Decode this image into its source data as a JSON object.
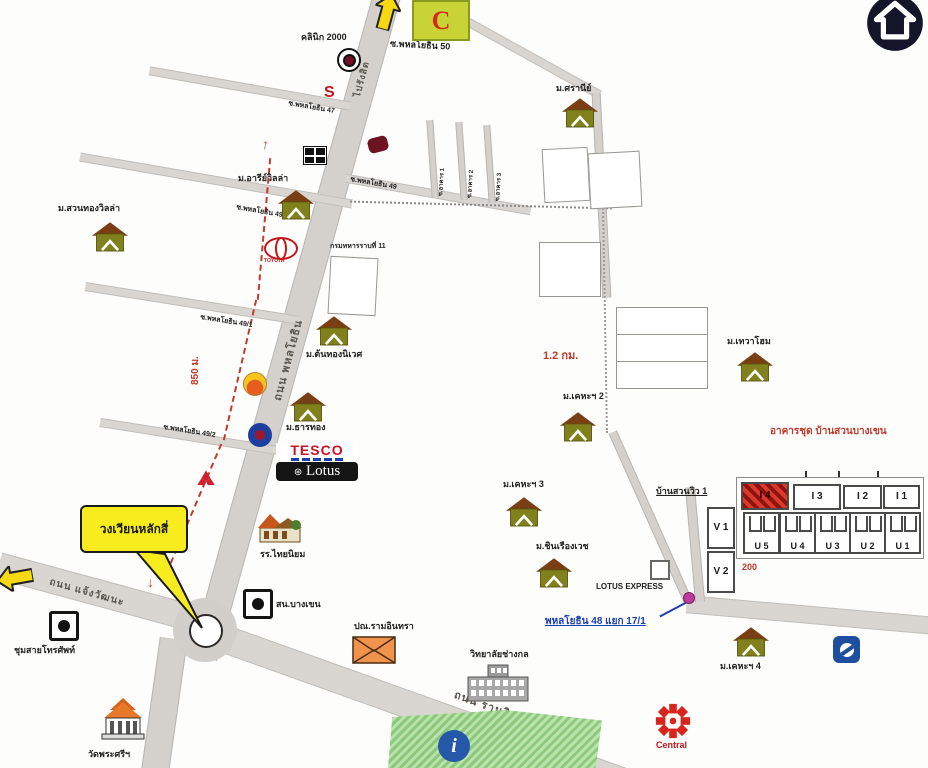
{
  "ui": {
    "home_button": "back-to-top"
  },
  "roads": {
    "phahonyothin": "ถนน พหลโยธิน",
    "to_rangsit": "ไปรังสิต",
    "chaengwattana": "ถนน แจ้งวัฒนะ",
    "ramindra": "ถนน รามอินทรา",
    "soi_50": "ซ.พหลโยธิน 50",
    "soi_47": "ซ.พหลโยธิน 47",
    "soi_49_left": "ซ.พหลโยธิน 49",
    "soi_49_right": "ซ.พหลโยธิน 49",
    "soi_49_1": "ซ.พหลโยธิน 49/1",
    "soi_49_2": "ซ.พหลโยธิน 49/2",
    "soi_akan_1": "ซ.อาคาร 1",
    "soi_akan_2": "ซ.อาคาร 2",
    "soi_akan_3": "ซ.อาคาร 3",
    "phahonyothin_48": "พหลโยธิน 48 แยก 17/1"
  },
  "distances": {
    "d850": "850 ม.",
    "d1200": "1.2 กม.",
    "d200": "200"
  },
  "callout": {
    "text": "วงเวียนหลักสี่"
  },
  "places": {
    "clinic": "คลินิก 2000",
    "bigc": "C",
    "suzuki": "S",
    "army": "กรมทหารราบที่ 11",
    "toyota": "TOYOTA",
    "tesco": "TESCO",
    "lotus": "Lotus",
    "lotus_express": "LOTUS EXPRESS",
    "police": "สน.บางเขน",
    "school": "รร.ไทยนิยม",
    "phone_exchange": "ชุมสายโทรศัพท์",
    "temple": "วัดพระศรีฯ",
    "post_office": "ปณ.รามอินทรา",
    "college": "วิทยาลัยช่างกล",
    "central": "Central"
  },
  "villages": [
    {
      "label": "ม.ศรานีย์"
    },
    {
      "label": "ม.อารีย์วิลล่า"
    },
    {
      "label": "ม.สวนทองวิลล่า"
    },
    {
      "label": "ม.ต้นทองนิเวศ"
    },
    {
      "label": "ม.ธารทอง"
    },
    {
      "label": "ม.เทวาโฮม"
    },
    {
      "label": "ม.เคหะฯ 2"
    },
    {
      "label": "ม.เคหะฯ 3"
    },
    {
      "label": "ม.ชินเรืองเวช"
    },
    {
      "label": "ม.เคหะฯ 4"
    }
  ],
  "condo": {
    "title": "อาคารชุด บ้านสวนบางเขน",
    "annex": "บ้านสวนวิว 1",
    "row1": [
      {
        "label": "I 4"
      },
      {
        "label": "I 3"
      },
      {
        "label": "I 2"
      },
      {
        "label": "I 1"
      }
    ],
    "row2": [
      {
        "label": "U 5"
      },
      {
        "label": "U 4"
      },
      {
        "label": "U 3"
      },
      {
        "label": "U 2"
      },
      {
        "label": "U 1"
      }
    ],
    "side": [
      {
        "label": "V 1"
      },
      {
        "label": "V 2"
      }
    ]
  }
}
